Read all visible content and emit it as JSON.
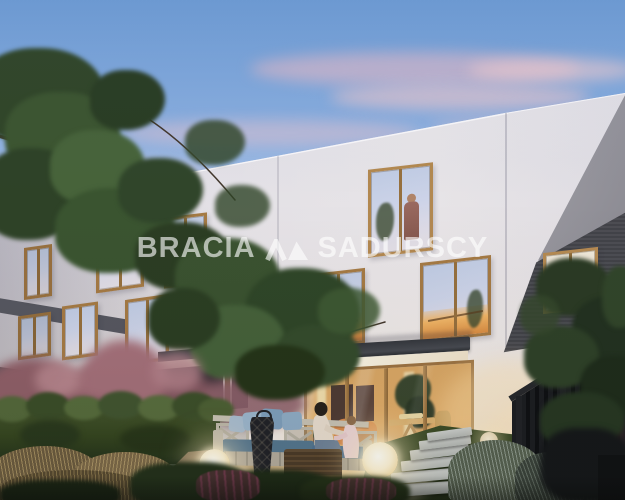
{
  "image": {
    "title": "Townhouse development garden view at dusk",
    "width_px": 625,
    "height_px": 500
  },
  "watermark": {
    "text_left": "BRACIA",
    "text_right": "SADURSCY",
    "mark_icon": "double-peak-triangle-logo",
    "color": "#ffffff",
    "opacity": 0.62
  },
  "palette": {
    "sky_top": "#6f9dd5",
    "sky_horizon": "#e6dde9",
    "cloud_pink": "#eec3cb",
    "facade_white": "#e6e4e9",
    "accent_graphite": "#45464c",
    "window_wood": "#a57a44",
    "glass_reflection": "#ccd3e8",
    "warm_interior_light": "#e3ae69",
    "awning_dark": "#3a3d43",
    "hedge_green": "#41502c",
    "lawn_green": "#3c4d26",
    "lamp_glow": "#fdf3d6",
    "fence_dark": "#17191d",
    "pink_foliage": "#a06d76",
    "paver_gray": "#c6c9c6",
    "sofa_wood": "#c9c4b6",
    "cushion_blue": "#54768f",
    "patio_floor": "#d3b98a"
  },
  "scene": {
    "elements": [
      "dusk sky with pink clouds",
      "white townhouse row with graphite gable",
      "oak framed windows, some warm-lit",
      "person standing at upper window",
      "awning over lit glass patio wall",
      "interior with orange armchairs, cross-leg table, plants",
      "garden hedge and pink shrubs",
      "L-shaped outdoor sofa with blue cushions",
      "mother and child sitting on patio",
      "black lantern and wicker ottoman",
      "three glowing sphere lamps",
      "stepping stone path on lawn",
      "dark vertical-slat fence with tree",
      "ornamental grasses in foreground",
      "overhanging tree branches top-left"
    ]
  }
}
